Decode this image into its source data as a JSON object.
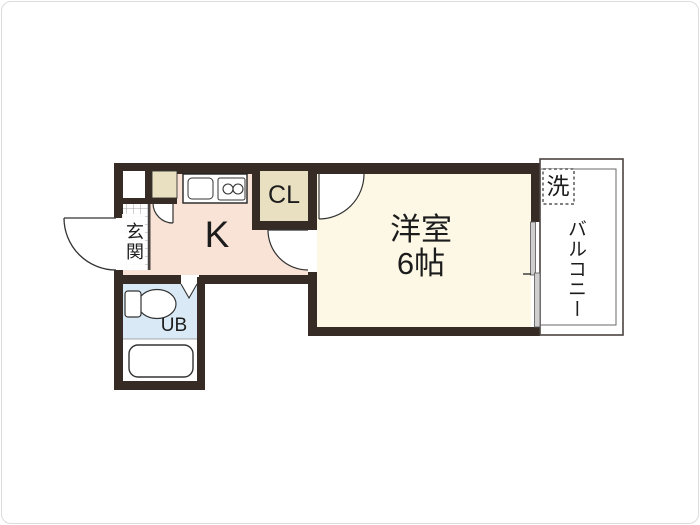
{
  "plan": {
    "type": "floor-plan",
    "labels": {
      "kitchen": "K",
      "closet": "CL",
      "room_line1": "洋室",
      "room_line2": "6帖",
      "entrance": "玄関",
      "unit_bath": "UB",
      "washer": "洗",
      "balcony": "バルコニー"
    },
    "colors": {
      "wall": "#362c25",
      "kitchen_floor": "#f9e3d7",
      "room_floor": "#fcf8e5",
      "closet_fill": "#e9e0c1",
      "bath_fill": "#d9eaf6",
      "line": "#333333"
    }
  }
}
